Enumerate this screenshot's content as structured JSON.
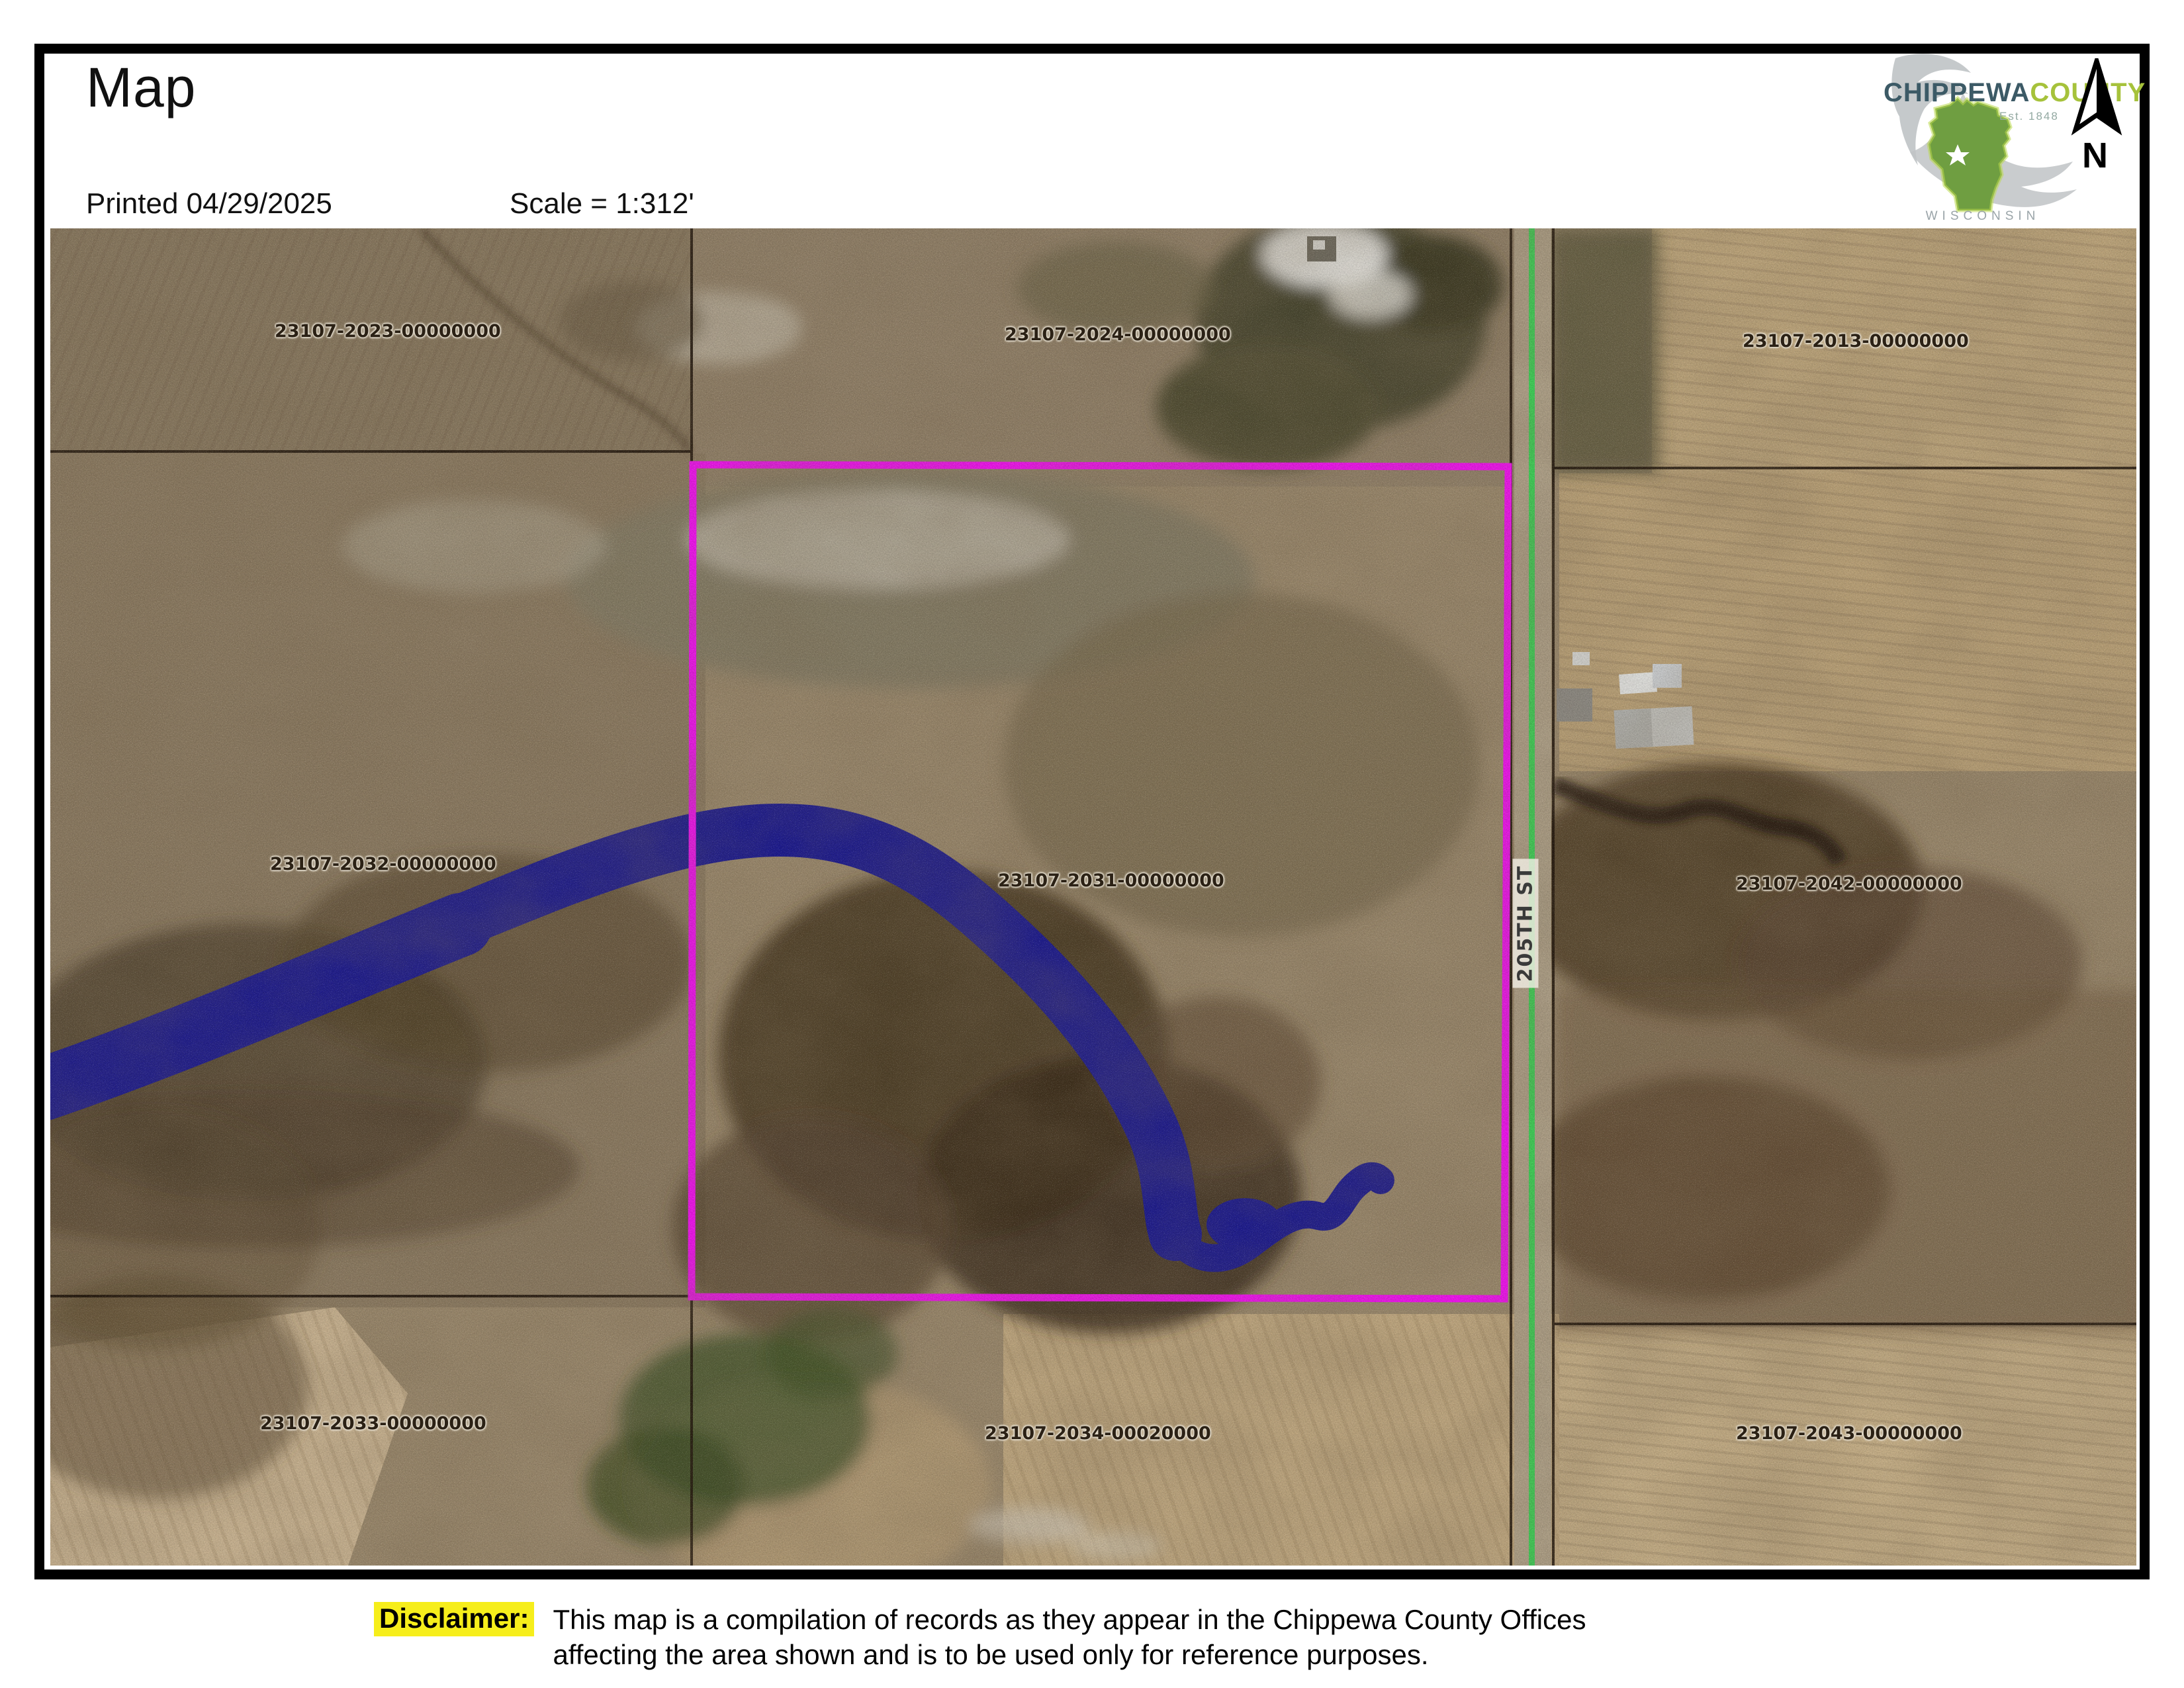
{
  "header": {
    "title": "Map",
    "printed": "Printed 04/29/2025",
    "scale": "Scale = 1:312'",
    "logo": {
      "name_part1": "CHIPPEWA",
      "name_part2": "COUNTY",
      "est": "Est. 1848",
      "state": "WISCONSIN"
    },
    "north_label": "N"
  },
  "map": {
    "road_label": "205TH ST",
    "parcels": [
      {
        "label": "23107-2023-00000000"
      },
      {
        "label": "23107-2024-00000000"
      },
      {
        "label": "23107-2013-00000000"
      },
      {
        "label": "23107-2032-00000000"
      },
      {
        "label": "23107-2031-00000000"
      },
      {
        "label": "23107-2042-00000000"
      },
      {
        "label": "23107-2033-00000000"
      },
      {
        "label": "23107-2034-00020000"
      },
      {
        "label": "23107-2043-00000000"
      }
    ],
    "colors": {
      "selected_parcel_outline": "#F311F3",
      "water": "#1E1C90",
      "road_centerline": "#3ED158",
      "parcel_line": "#1A1008"
    }
  },
  "disclaimer": {
    "label": "Disclaimer:",
    "line1": "This map is a compilation of records as they appear in the Chippewa County Offices",
    "line2": "affecting the area shown and is to be used only for reference purposes.",
    "highlight_color": "#F6EE1B"
  }
}
